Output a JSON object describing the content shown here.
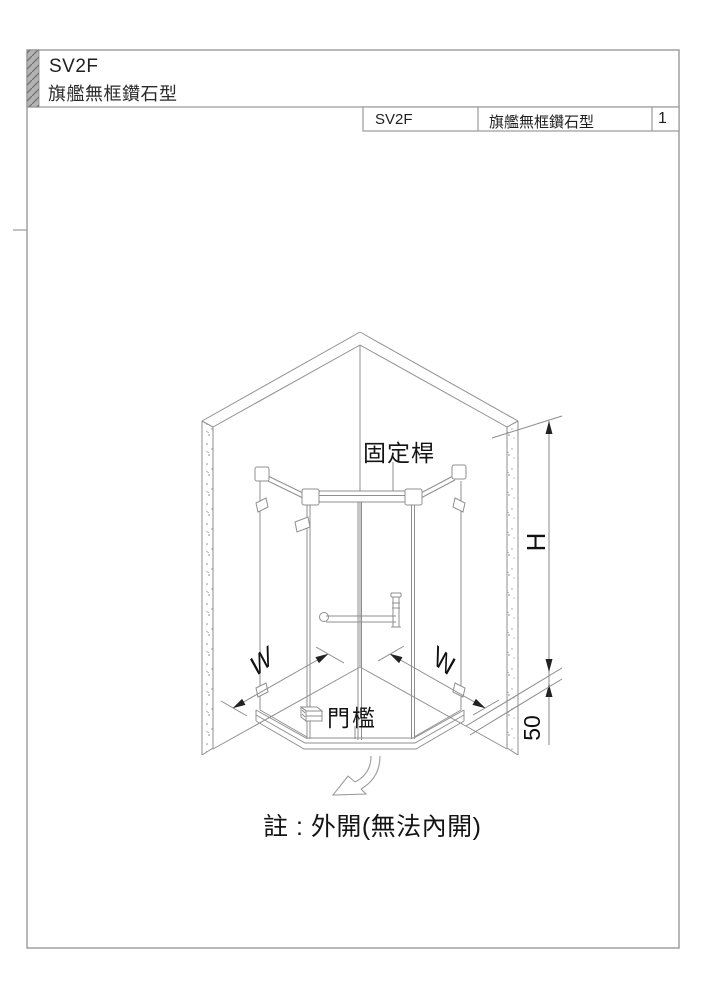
{
  "header": {
    "model": "SV2F",
    "series_name": "旗艦無框鑽石型"
  },
  "title_block": {
    "model": "SV2F",
    "name": "旗艦無框鑽石型",
    "page_number": "1"
  },
  "diagram": {
    "labels": {
      "fixed_bar": "固定桿",
      "threshold": "門檻"
    },
    "dimensions": {
      "width_left": "W",
      "width_right": "W",
      "height": "H",
      "threshold_height": "50"
    },
    "note": "註 : 外開(無法內開)"
  },
  "colors": {
    "line_gray": "#8f8f8f",
    "border_gray": "#9a9a9a",
    "text_dark": "#1d1d1d",
    "arrow_black": "#222222",
    "header_bar_fill": "#b3b3b3"
  }
}
